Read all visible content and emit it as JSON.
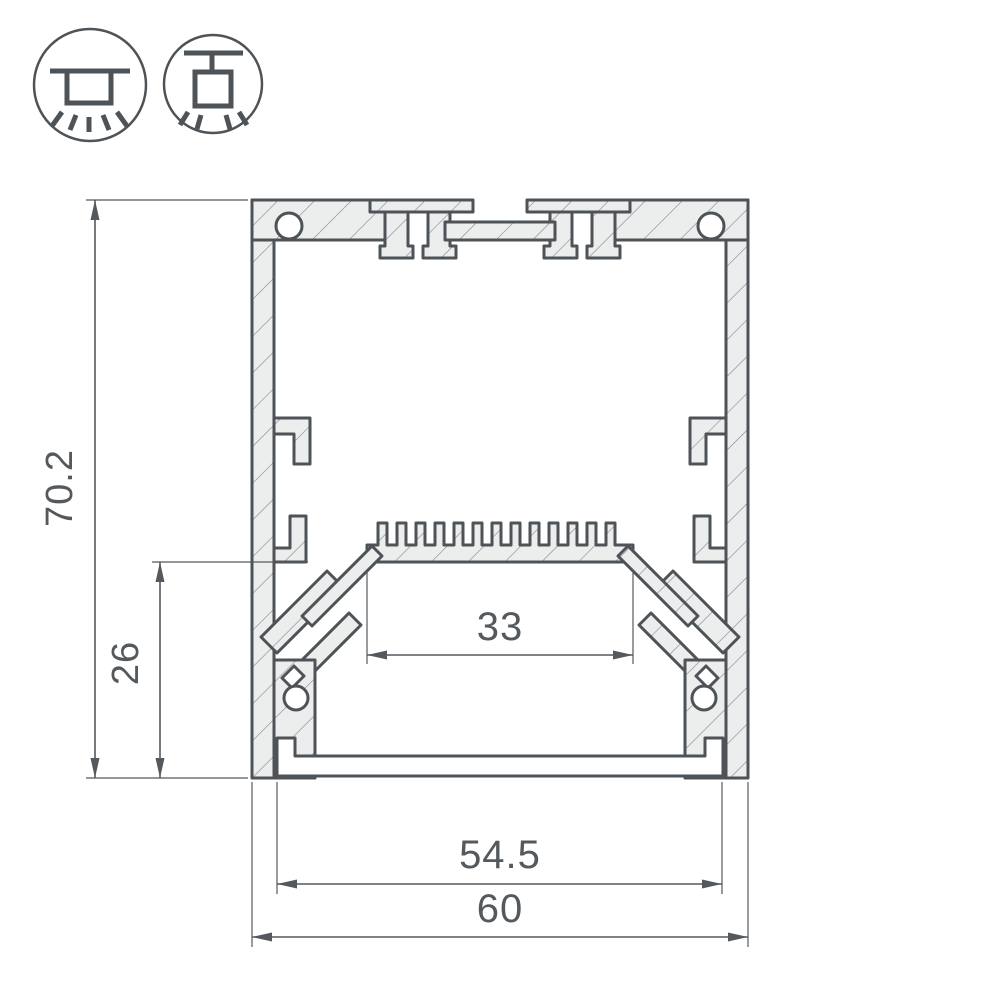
{
  "page": {
    "background": "#ffffff"
  },
  "colors": {
    "line": "#4d5357",
    "fill": "#eceeee",
    "hatch_line": "#848a8f",
    "dim": "#54595e",
    "background": "#ffffff"
  },
  "icons": {
    "surface_mount": {
      "name": "surface-mounted-luminaire"
    },
    "pendant_mount": {
      "name": "pendant-suspended-luminaire"
    }
  },
  "drawing": {
    "type": "led-profile-cross-section",
    "dimensions": {
      "overall_height": "70.2",
      "side_mount_depth": "26",
      "inner_width": "33",
      "diffuser_width": "54.5",
      "overall_width": "60"
    }
  }
}
